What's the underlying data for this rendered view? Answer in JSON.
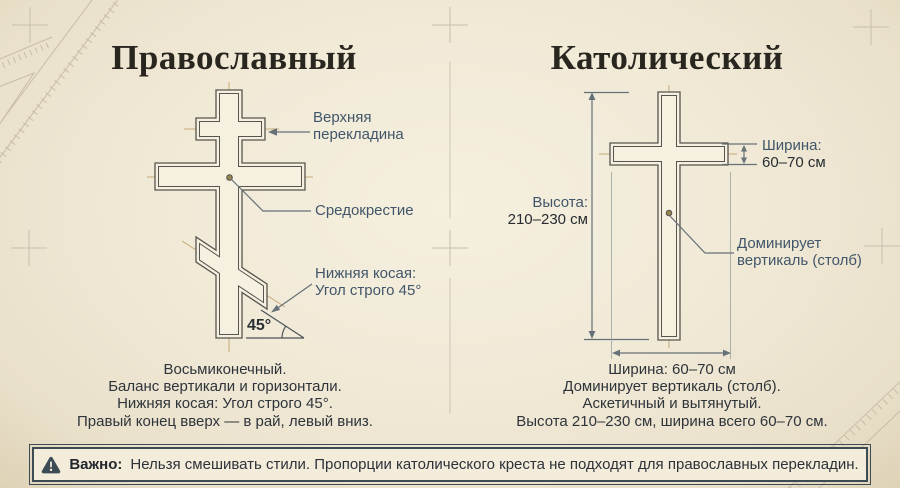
{
  "left": {
    "title": "Православный",
    "labels": {
      "upper_crossbar_line1": "Верхняя",
      "upper_crossbar_line2": "перекладина",
      "crossing": "Средокрестие",
      "lower_slant_line1": "Нижняя косая:",
      "lower_slant_line2": "Угол строго 45°",
      "angle": "45°"
    },
    "summary": [
      "Восьмиконечный.",
      "Баланс вертикали и горизонтали.",
      "Нижняя косая: Угол строго 45°.",
      "Правый конец вверх — в рай, левый вниз."
    ]
  },
  "right": {
    "title": "Католический",
    "labels": {
      "width_label": "Ширина:",
      "width_value": "60–70 см",
      "height_label": "Высота:",
      "height_value": "210–230 см",
      "dominant_line1": "Доминирует",
      "dominant_line2": "вертикаль (столб)"
    },
    "summary": [
      "Ширина: 60–70 см",
      "Доминирует вертикаль (столб).",
      "Аскетичный и вытянутый.",
      "Высота 210–230 см, ширина всего 60–70 см."
    ]
  },
  "warning": {
    "icon": "warning-triangle-icon",
    "bold": "Важно:",
    "text": "Нельзя смешивать стили. Пропорции католического креста не подходят для православных перекладин."
  },
  "colors": {
    "bg": "#efe8d5",
    "ink": "#56544e",
    "label": "#41566a",
    "dark": "#2e343a",
    "tan": "#c2a26d",
    "dim": "#667077",
    "warn": "#3d4b55",
    "title": "#292620"
  }
}
